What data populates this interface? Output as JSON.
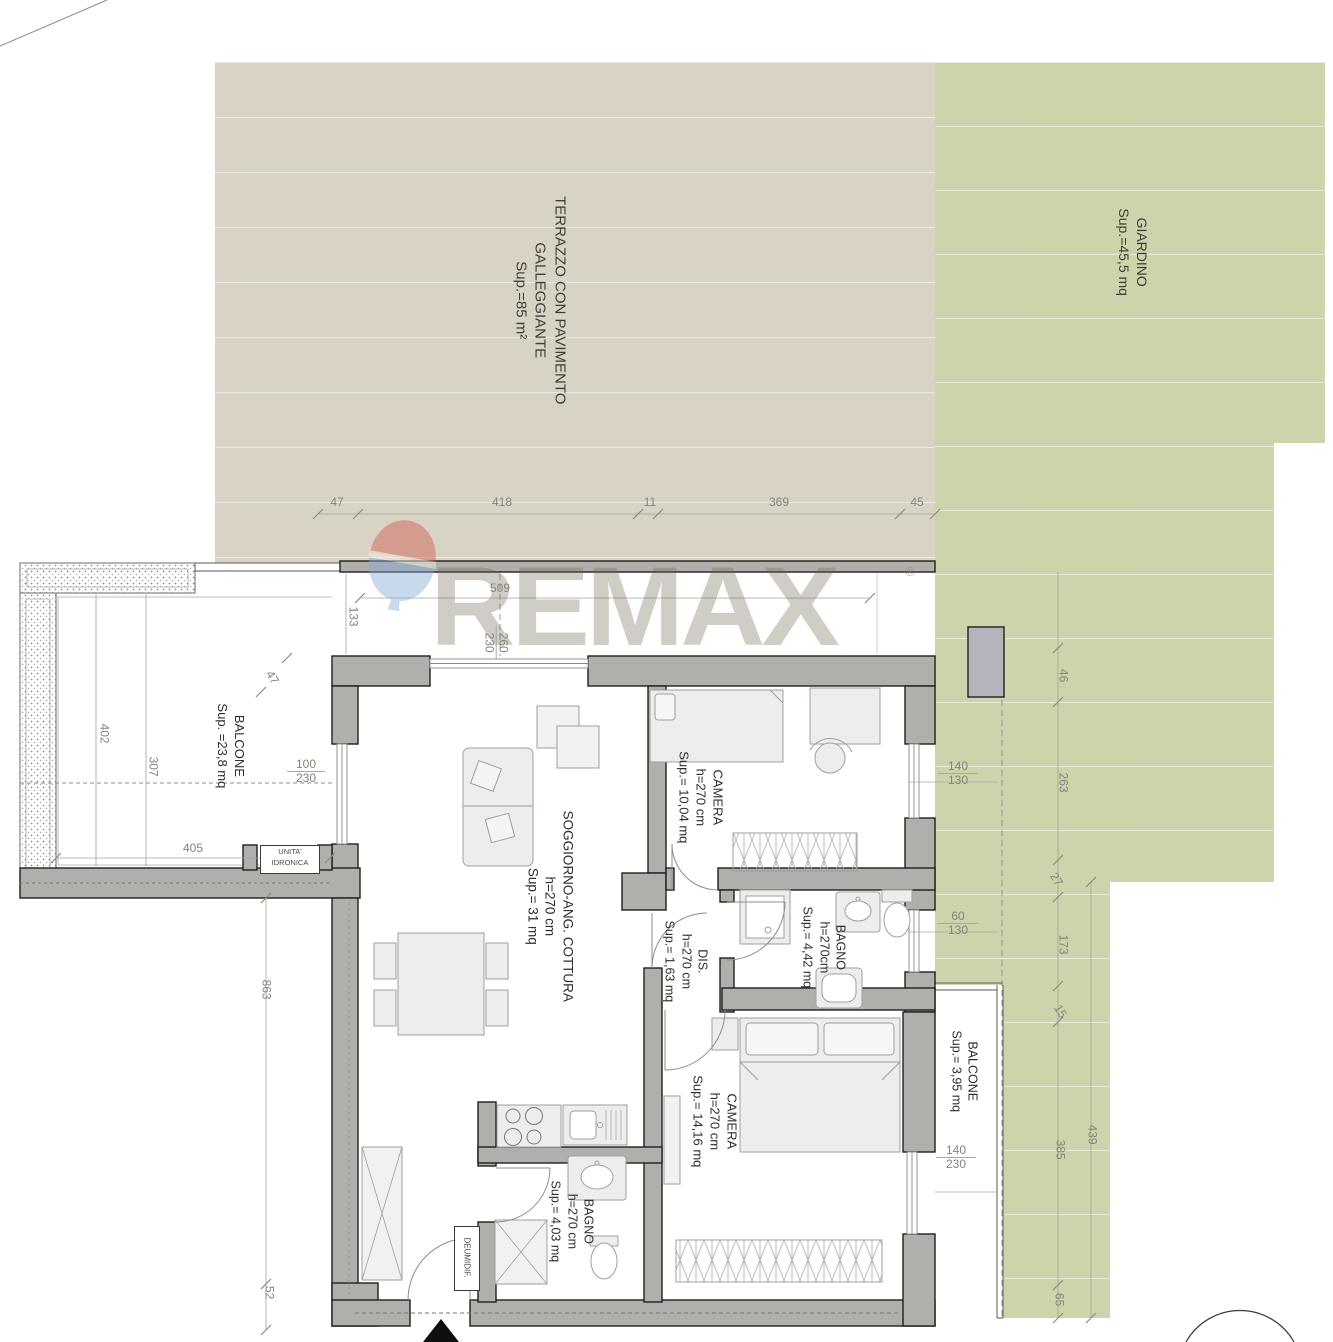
{
  "watermark": {
    "brand": "REMAX",
    "registered": "®"
  },
  "terrazzo": {
    "line1": "TERRAZZO CON PAVIMENTO",
    "line2": "GALLEGGIANTE",
    "area": "Sup.=85 m²"
  },
  "giardino": {
    "name": "GIARDINO",
    "area": "Sup.=45,5 mq"
  },
  "rooms": {
    "balcone_left": {
      "name": "BALCONE",
      "area": "Sup. =23,8 mq"
    },
    "soggiorno": {
      "name": "SOGGIORNO-ANG. COTTURA",
      "h": "h=270 cm",
      "area": "Sup.= 31 mq"
    },
    "camera1": {
      "name": "CAMERA",
      "h": "h=270 cm",
      "area": "Sup.= 10,04 mq"
    },
    "dis": {
      "name": "DIS.",
      "h": "h=270 cm",
      "area": "Sup.= 1,63 mq"
    },
    "bagno1": {
      "name": "BAGNO",
      "h": "h=270cm",
      "area": "Sup.= 4,42 mq"
    },
    "camera2": {
      "name": "CAMERA",
      "h": "h=270 cm",
      "area": "Sup.= 14,16 mq"
    },
    "bagno2": {
      "name": "BAGNO",
      "h": "h=270 cm",
      "area": "Sup.= 4,03 mq"
    },
    "balcone_right": {
      "name": "BALCONE",
      "area": "Sup.= 3,95 mq"
    }
  },
  "equipment": {
    "unita1": "UNITA'",
    "unita2": "IDRONICA",
    "deumidif": "DEUMIDIF."
  },
  "dims": {
    "chain_top": {
      "a": "47",
      "b": "418",
      "c": "11",
      "d": "369",
      "e": "45"
    },
    "strip": {
      "w509": "509",
      "h133": "133",
      "p260": "260",
      "p230": "230"
    },
    "balcone": {
      "diag47": "47",
      "v402": "402",
      "v307": "307",
      "w405": "405"
    },
    "opening": {
      "w100": "100",
      "h230": "230"
    },
    "left": {
      "v863": "863",
      "v52": "52"
    },
    "win1": {
      "w": "140",
      "h": "130"
    },
    "win2": {
      "w": "60",
      "h": "130"
    },
    "win3": {
      "w": "140",
      "h": "230"
    },
    "garden": {
      "v46": "46",
      "v263": "263",
      "d27": "27",
      "v173": "173",
      "d15": "15",
      "v439": "439",
      "v385": "385",
      "v65": "65"
    }
  },
  "colors": {
    "terrace": "#d9d3c5",
    "garden": "#cdd3aa",
    "wall": "#b1afac",
    "dim_text": "#83837c",
    "balloon_red": "#cf5246",
    "balloon_blue": "#86abd6"
  }
}
